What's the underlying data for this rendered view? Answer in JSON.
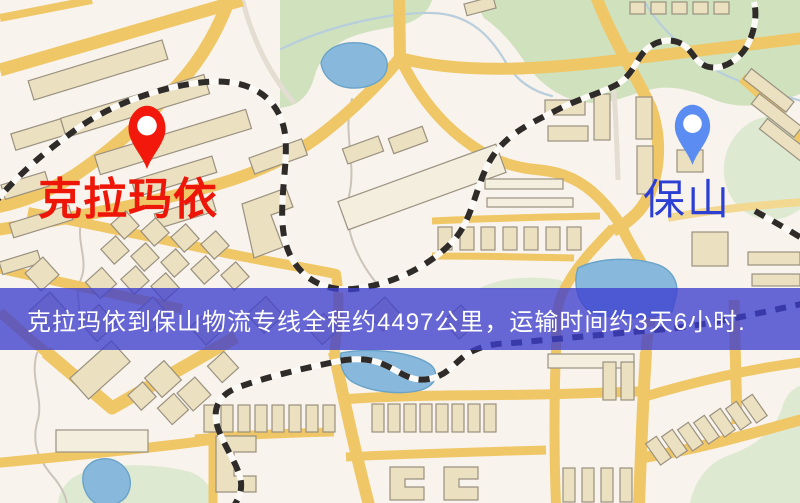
{
  "markers": {
    "origin": {
      "label": "克拉玛依",
      "icon": "map-pin"
    },
    "destination": {
      "label": "保山",
      "icon": "map-pin"
    }
  },
  "banner": {
    "text": "克拉玛依到保山物流专线全程约4497公里，运输时间约3天6小时."
  },
  "colors": {
    "origin-pin": "#f2180c",
    "origin-label": "#ed1608",
    "destination-pin": "#5b8cf2",
    "destination-label": "#2c3fd4",
    "banner-bg": "rgba(60,62,206,0.78)",
    "banner-text": "#ffffff",
    "road-yellow": "#f0c766",
    "road-yellow-light": "#f3d892",
    "map-base": "#f8f3ec",
    "park-green": "#cfe1bd",
    "park-green-light": "#dee9d1",
    "water-blue": "#88b9dd",
    "building-fill": "#ebe0c0",
    "building-stroke": "#9a9180",
    "railway-dark": "#2e2b28"
  }
}
